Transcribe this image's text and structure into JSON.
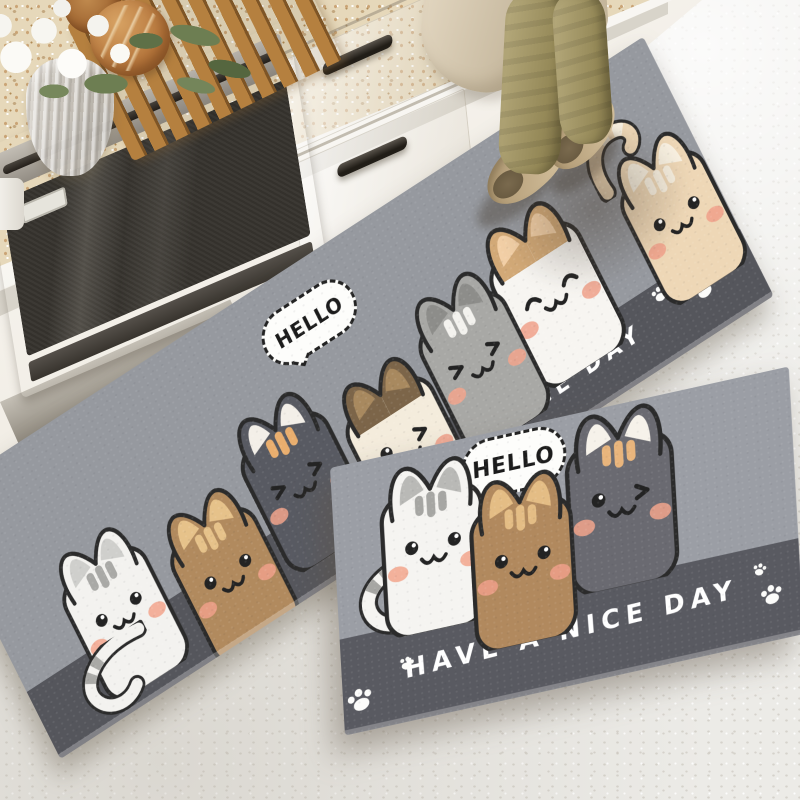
{
  "runner_mat": {
    "bubble_text": "HELLO",
    "message": "HAVE A NICE DAY",
    "colors": {
      "field": "#96999f",
      "band": "#55565c",
      "message_text": "#ffffff",
      "outline": "#2b2b2b",
      "blush": "#f2a48c"
    },
    "cats": [
      {
        "name": "white-tabby-cat",
        "body": "#f3f2ef",
        "stripe": "#a9a9a6",
        "ear_fill": "#f3f2ef",
        "ear_inner": "#cfcfcc",
        "expression": "open",
        "blush": "#f2a48c"
      },
      {
        "name": "brown-tabby-cat",
        "body": "#b18a5e",
        "stripe": "#e6c28a",
        "ear_fill": "#b18a5e",
        "ear_inner": "#e6c28a",
        "expression": "open",
        "blush": "#f0a08a"
      },
      {
        "name": "dark-gray-tabby-cat",
        "body": "#585a62",
        "stripe": "#e9ae6e",
        "ear_fill": "#585a62",
        "ear_inner": "#f3efe8",
        "expression": "squint",
        "blush": "#f2a48c"
      },
      {
        "name": "cream-siamese-cat",
        "body": "#f4ecdc",
        "stripe": "",
        "ear_fill": "#7c6549",
        "ear_inner": "#a8895f",
        "expression": "wink",
        "blush": "#f0a08a"
      },
      {
        "name": "gray-tabby-cat",
        "body": "#a8a8a5",
        "stripe": "#f3f2ee",
        "ear_fill": "#a8a8a5",
        "ear_inner": "#8d8d8a",
        "expression": "squint",
        "blush": "#f2a48c"
      },
      {
        "name": "white-happy-cat",
        "body": "#f7f5f1",
        "stripe": "",
        "ear_fill": "#d2a977",
        "ear_inner": "#f2cfa6",
        "expression": "happy",
        "blush": "#f0a08a"
      },
      {
        "name": "tan-cat",
        "body": "#eed7b6",
        "stripe": "#f9f1e1",
        "ear_fill": "#eed7b6",
        "ear_inner": "#f9f1e1",
        "expression": "open",
        "blush": "#f0a08a"
      }
    ]
  },
  "front_mat": {
    "bubble_text": "HELLO",
    "message": "HAVE A NICE DAY",
    "colors": {
      "field": "#9b9ea5",
      "band": "#595a61",
      "message_text": "#ffffff"
    },
    "cats": [
      {
        "name": "white-tabby-cat",
        "body": "#f5f4f1",
        "stripe": "#a6a6a3",
        "ear_fill": "#f5f4f1",
        "ear_inner": "#b9b9b6",
        "expression": "open",
        "blush": "#f2a48c"
      },
      {
        "name": "brown-tabby-cat",
        "body": "#b1895e",
        "stripe": "#e4bd85",
        "ear_fill": "#b1895e",
        "ear_inner": "#e4bd85",
        "expression": "open",
        "blush": "#f0a08a"
      },
      {
        "name": "dark-gray-cat",
        "body": "#6a6a71",
        "stripe": "#e9b57c",
        "ear_fill": "#6a6a71",
        "ear_inner": "#f6f2ea",
        "expression": "wink",
        "blush": "#f2a48c"
      }
    ]
  }
}
